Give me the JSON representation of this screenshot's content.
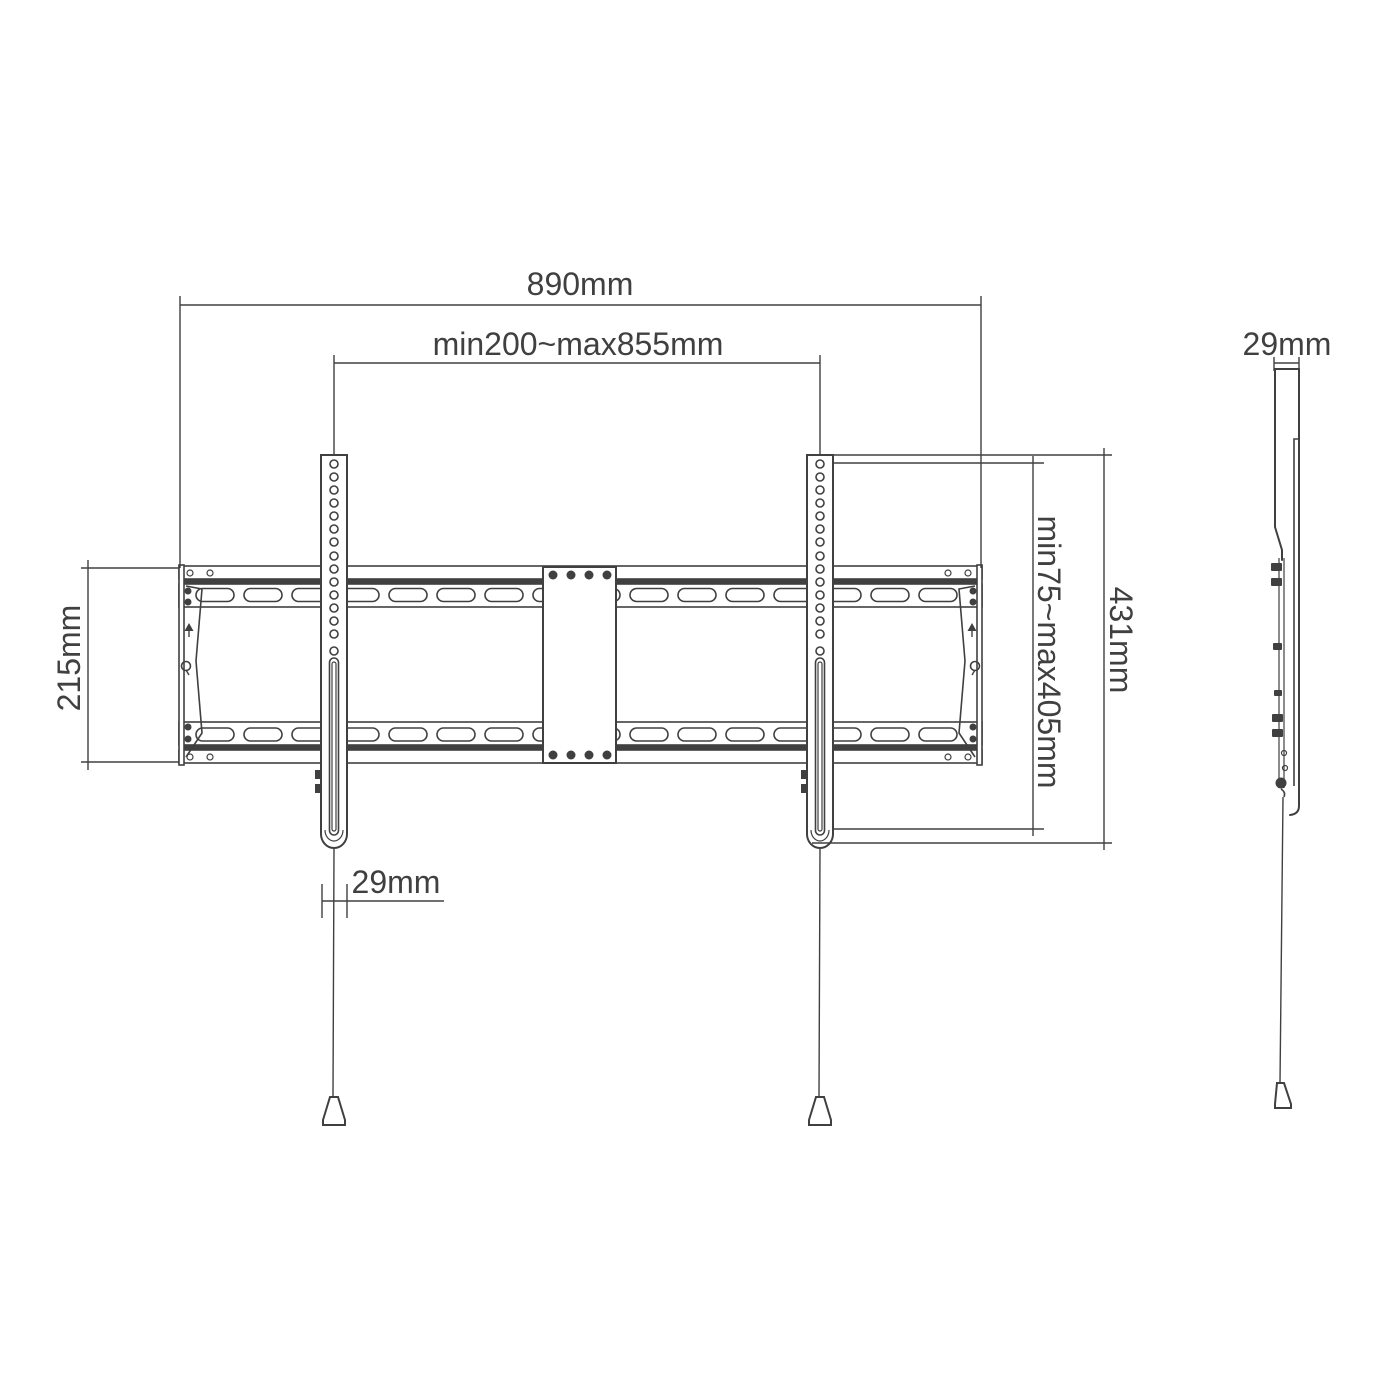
{
  "labels": {
    "overall_width": "890mm",
    "mount_width_range": "min200~max855mm",
    "rail_height": "215mm",
    "arm_width": "29mm",
    "vesa_height_range": "min75~max405mm",
    "arm_height": "431mm",
    "side_depth": "29mm"
  },
  "colors": {
    "line": "#404040",
    "background": "#ffffff"
  }
}
